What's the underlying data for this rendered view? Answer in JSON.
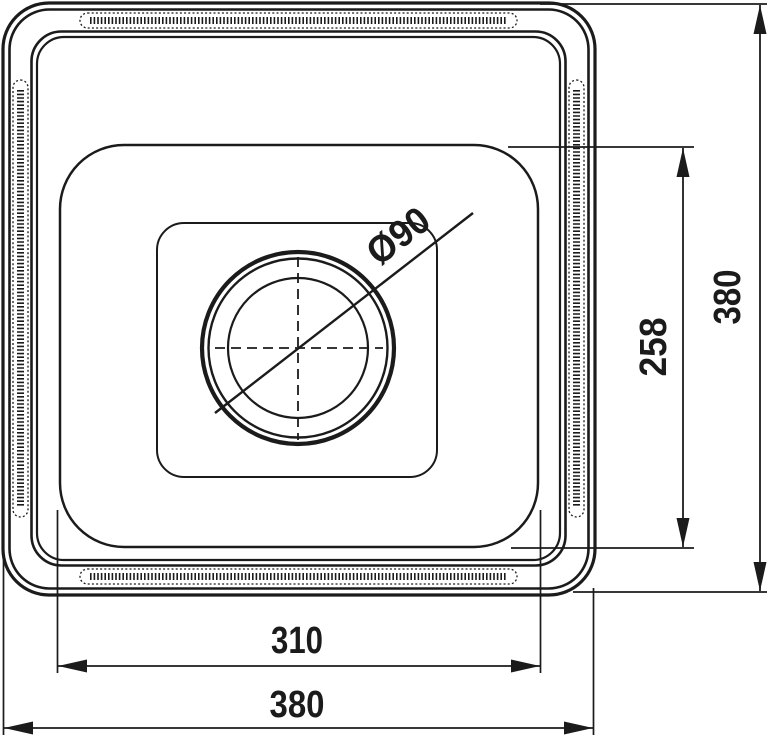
{
  "drawing": {
    "background": "#ffffff",
    "line_color": "#1b1b1b",
    "dimensions": {
      "drain_diameter": {
        "value": "Ø90"
      },
      "bowl_depth": {
        "value": "258"
      },
      "overall_height": {
        "value": "380"
      },
      "bowl_width": {
        "value": "310"
      },
      "overall_width": {
        "value": "380"
      }
    }
  }
}
